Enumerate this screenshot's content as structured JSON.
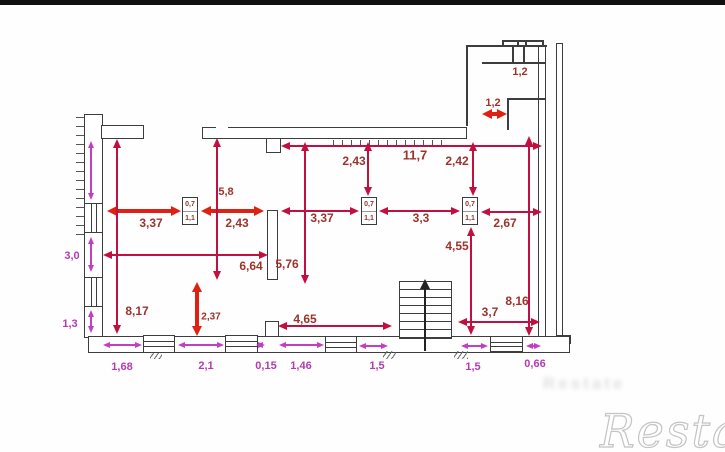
{
  "colors": {
    "red": "#de2113",
    "crimson": "#c11040",
    "magenta": "#c23ec2",
    "wall": "#3d3d3d",
    "label_red": "#9c332c",
    "label_magenta": "#b33ab3"
  },
  "watermark": {
    "main": "Restate",
    "ghost": "Restate"
  },
  "column": {
    "width_label": "0,7",
    "depth_label": "1,1"
  },
  "columns": [
    {
      "x": 182,
      "y": 197
    },
    {
      "x": 361,
      "y": 197
    },
    {
      "x": 462,
      "y": 197
    }
  ],
  "dimensions": [
    {
      "value": "3,37",
      "color": "red",
      "orient": "h",
      "a": 107,
      "b": 181,
      "at": 211,
      "lx": 151,
      "ly": 223
    },
    {
      "value": "2,43",
      "color": "red",
      "orient": "h",
      "a": 201,
      "b": 264,
      "at": 211,
      "lx": 237,
      "ly": 223
    },
    {
      "value": "2,37",
      "color": "red",
      "orient": "v",
      "a": 282,
      "b": 336,
      "at": 197,
      "lx": 211,
      "ly": 317,
      "fs": 10
    },
    {
      "value": "1,2",
      "color": "red",
      "orient": "h",
      "a": 482,
      "b": 507,
      "at": 114,
      "lx": 493,
      "ly": 103,
      "fs": 11
    },
    {
      "value": "1,2",
      "color": "red",
      "orient": "none",
      "lx": 520,
      "ly": 72,
      "fs": 11
    },
    {
      "value": "8,17",
      "color": "crimson",
      "orient": "v",
      "a": 139,
      "b": 334,
      "at": 117,
      "lx": 137,
      "ly": 311
    },
    {
      "value": "5,8",
      "color": "crimson",
      "orient": "v",
      "a": 138,
      "b": 280,
      "at": 217,
      "lx": 226,
      "ly": 192,
      "fs": 11
    },
    {
      "value": "5,76",
      "color": "crimson",
      "orient": "v",
      "a": 142,
      "b": 284,
      "at": 305,
      "lx": 287,
      "ly": 264
    },
    {
      "value": "6,64",
      "color": "crimson",
      "orient": "h",
      "a": 103,
      "b": 268,
      "at": 255,
      "lx": 251,
      "ly": 266
    },
    {
      "value": "11,7",
      "color": "crimson",
      "orient": "h",
      "a": 281,
      "b": 542,
      "at": 146,
      "lx": 415,
      "ly": 155,
      "fs": 13
    },
    {
      "value": "2,43",
      "color": "crimson",
      "orient": "v",
      "a": 142,
      "b": 196,
      "at": 368,
      "lx": 354,
      "ly": 161
    },
    {
      "value": "2,42",
      "color": "crimson",
      "orient": "v",
      "a": 142,
      "b": 196,
      "at": 473,
      "lx": 457,
      "ly": 161
    },
    {
      "value": "3,37",
      "color": "crimson",
      "orient": "h",
      "a": 281,
      "b": 359,
      "at": 211,
      "lx": 322,
      "ly": 218
    },
    {
      "value": "3,3",
      "color": "crimson",
      "orient": "h",
      "a": 379,
      "b": 460,
      "at": 211,
      "lx": 421,
      "ly": 218
    },
    {
      "value": "2,67",
      "color": "crimson",
      "orient": "h",
      "a": 481,
      "b": 542,
      "at": 212,
      "lx": 505,
      "ly": 223
    },
    {
      "value": "4,55",
      "color": "crimson",
      "orient": "v",
      "a": 227,
      "b": 335,
      "at": 471,
      "lx": 457,
      "ly": 246
    },
    {
      "value": "8,16",
      "color": "crimson",
      "orient": "v",
      "a": 136,
      "b": 336,
      "at": 529,
      "lx": 517,
      "ly": 301
    },
    {
      "value": "3,7",
      "color": "crimson",
      "orient": "h",
      "a": 458,
      "b": 540,
      "at": 322,
      "lx": 490,
      "ly": 312
    },
    {
      "value": "4,65",
      "color": "crimson",
      "orient": "h",
      "a": 278,
      "b": 392,
      "at": 326,
      "lx": 305,
      "ly": 319
    },
    {
      "value": "",
      "color": "magenta",
      "orient": "v",
      "a": 141,
      "b": 200,
      "at": 91,
      "lx": 0,
      "ly": 0
    },
    {
      "value": "3,0",
      "color": "magenta",
      "orient": "v",
      "a": 237,
      "b": 272,
      "at": 91,
      "lx": 72,
      "ly": 256
    },
    {
      "value": "1,3",
      "color": "magenta",
      "orient": "v",
      "a": 310,
      "b": 333,
      "at": 91,
      "lx": 70,
      "ly": 324
    },
    {
      "value": "1,68",
      "color": "magenta",
      "orient": "h",
      "a": 103,
      "b": 142,
      "at": 345,
      "lx": 122,
      "ly": 367
    },
    {
      "value": "2,1",
      "color": "magenta",
      "orient": "h",
      "a": 178,
      "b": 224,
      "at": 345,
      "lx": 206,
      "ly": 366
    },
    {
      "value": "0,15",
      "color": "magenta",
      "orient": "h",
      "a": 256,
      "b": 265,
      "at": 345,
      "lx": 266,
      "ly": 366
    },
    {
      "value": "1,46",
      "color": "magenta",
      "orient": "h",
      "a": 279,
      "b": 324,
      "at": 345,
      "lx": 301,
      "ly": 366
    },
    {
      "value": "1,5",
      "color": "magenta",
      "orient": "h",
      "a": 359,
      "b": 388,
      "at": 346,
      "lx": 377,
      "ly": 366
    },
    {
      "value": "1,5",
      "color": "magenta",
      "orient": "h",
      "a": 461,
      "b": 488,
      "at": 346,
      "lx": 473,
      "ly": 367
    },
    {
      "value": "0,66",
      "color": "magenta",
      "orient": "h",
      "a": 526,
      "b": 541,
      "at": 346,
      "lx": 535,
      "ly": 364
    }
  ]
}
